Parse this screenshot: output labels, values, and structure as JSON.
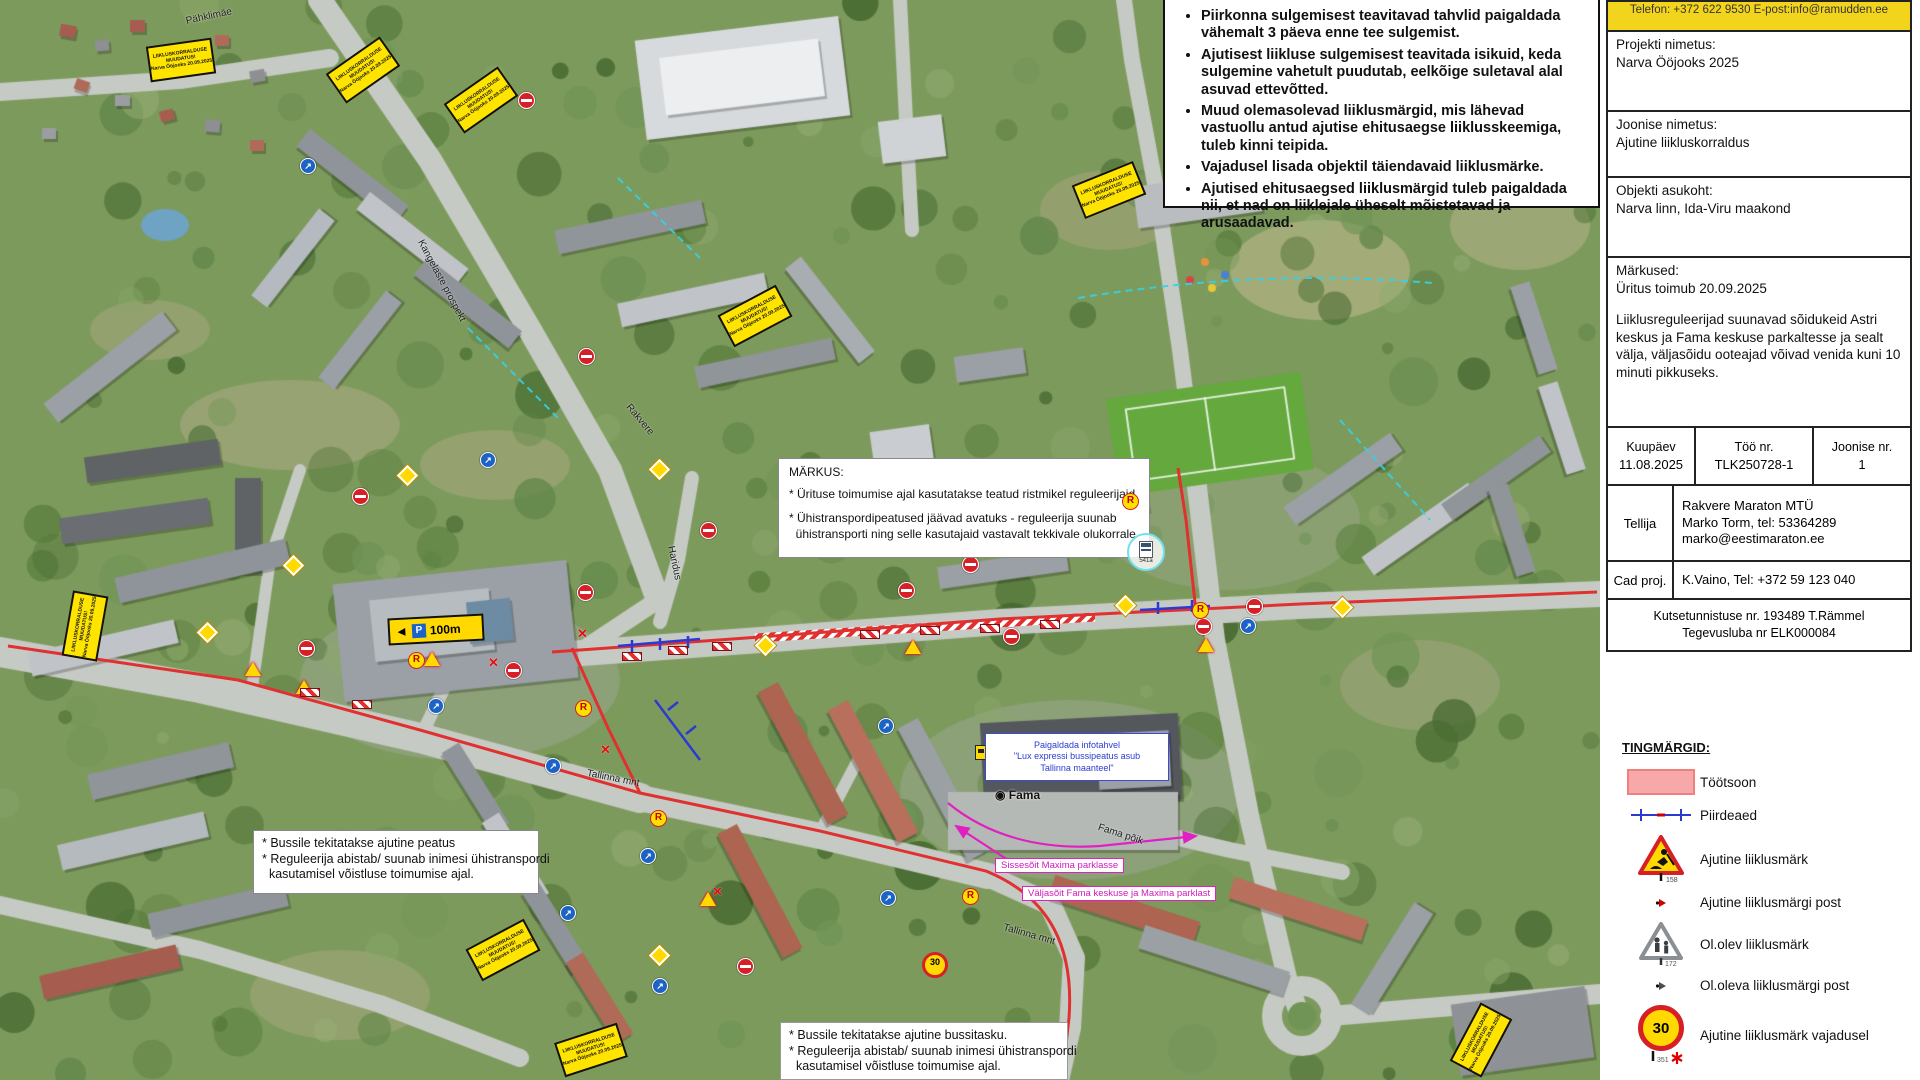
{
  "notes": {
    "items": [
      "Piirkonna sulgemisest teavitavad tahvlid paigaldada vähemalt 3 päeva enne tee sulgemist.",
      "Ajutisest liikluse sulgemisest teavitada isikuid, keda sulgemine vahetult puudutab, eelkõige suletaval alal asuvad ettevõtted.",
      "Muud olemasolevad liiklusmärgid, mis lähevad vastuollu antud ajutise ehitusaegse liiklusskeemiga, tuleb kinni teipida.",
      "Vajadusel lisada objektil täiendavaid liiklusmärke.",
      "Ajutised ehitusaegsed liiklusmärgid tuleb paigaldada nii, et nad on liiklejale üheselt mõistetavad ja arusaadavad."
    ]
  },
  "title_block": {
    "contact": "Telefon: +372 622 9530  E-post:info@ramudden.ee",
    "project_label": "Projekti nimetus:",
    "project_value": "Narva Ööjooks 2025",
    "drawing_label": "Joonise nimetus:",
    "drawing_value": "Ajutine liikluskorraldus",
    "location_label": "Objekti asukoht:",
    "location_value": "Narva linn, Ida-Viru maakond",
    "remarks_label": "Märkused:",
    "remarks_line1": "Üritus toimub 20.09.2025",
    "remarks_para": "Liiklusreguleerijad suunavad sõidukeid Astri keskus ja Fama keskuse parkaltesse ja sealt välja, väljasõidu ooteajad võivad venida kuni 10 minuti pikkuseks.",
    "date_label": "Kuupäev",
    "date_value": "11.08.2025",
    "work_label": "Töö nr.",
    "work_value": "TLK250728-1",
    "drawing_no_label": "Joonise nr.",
    "drawing_no_value": "1",
    "client_label": "Tellija",
    "client_line1": "Rakvere Maraton MTÜ",
    "client_line2": "Marko Torm, tel: 53364289",
    "client_line3": "marko@eestimaraton.ee",
    "cad_label": "Cad proj.",
    "cad_value": "K.Vaino, Tel: +372 59 123 040",
    "cert_line1": "Kutsetunnistuse nr. 193489 T.Rämmel",
    "cert_line2": "Tegevusluba nr ELK000084"
  },
  "legend": {
    "title": "TINGMÄRGID:",
    "items": [
      {
        "label": "Töötsoon"
      },
      {
        "label": "Piirdeaed"
      },
      {
        "label": "Ajutine liiklusmärk",
        "ref": "158"
      },
      {
        "label": "Ajutine liiklusmärgi post"
      },
      {
        "label": "Ol.olev liiklusmärk",
        "ref": "172"
      },
      {
        "label": "Ol.oleva liiklusmärgi post"
      },
      {
        "label": "Ajutine liiklusmärk vajadusel",
        "ref": "351"
      }
    ]
  },
  "map": {
    "markus_box": {
      "title": "MÄRKUS:",
      "item1": "* Ürituse toimumise ajal kasutatakse teatud ristmikel reguleerijaid",
      "item2_line1": "* Ühistranspordipeatused jäävad avatuks - reguleerija suunab",
      "item2_line2": "  ühistransporti ning selle kasutajaid vastavalt tekkivale olukorrale",
      "regulator_symbol": "R",
      "busstop_ref": "541a"
    },
    "bus_note_west": [
      "* Bussile tekitatakse ajutine peatus",
      "* Reguleerija abistab/ suunab inimesi ühistranspordi",
      "  kasutamisel võistluse toimumise ajal."
    ],
    "bus_note_south": [
      "* Bussile tekitatakse ajutine bussitasku.",
      "* Reguleerija abistab/ suunab inimesi ühistranspordi",
      "  kasutamisel võistluse toimumise ajal."
    ],
    "info_board_note": [
      "Paigaldada infotahvel",
      "\"Lux expressi bussipeatus asub",
      "Tallinna maanteel\""
    ],
    "maxima_in": "Sissesõit Maxima parklasse",
    "maxima_out": "Väljasõit Fama keskuse ja Maxima parklast",
    "notice_board_lines": [
      "LIIKLUSKORRALDUSE",
      "MUUDATUS!",
      "Narva Ööjooks 20.09.2025"
    ],
    "street_labels": [
      {
        "text": "Pähklimäe"
      },
      {
        "text": "Kangelaste prospekt"
      },
      {
        "text": "Rakvere"
      },
      {
        "text": "Haridus"
      },
      {
        "text": "Tallinna mnt"
      },
      {
        "text": "Tallinna mnt"
      },
      {
        "text": "Fama põik"
      }
    ],
    "poi_fama": "◉ Fama",
    "parking_sign": {
      "p": "P",
      "dist": "100m",
      "arrow": "◄"
    },
    "speed30": "30",
    "regulator_symbol": "R"
  },
  "colors": {
    "workzone": "#f7a8a8",
    "route_red": "#e03030",
    "fence_blue": "#2b3bd0",
    "notice_yellow": "#ffe400",
    "header_yellow": "#f2d41c",
    "magenta": "#e020c0"
  }
}
